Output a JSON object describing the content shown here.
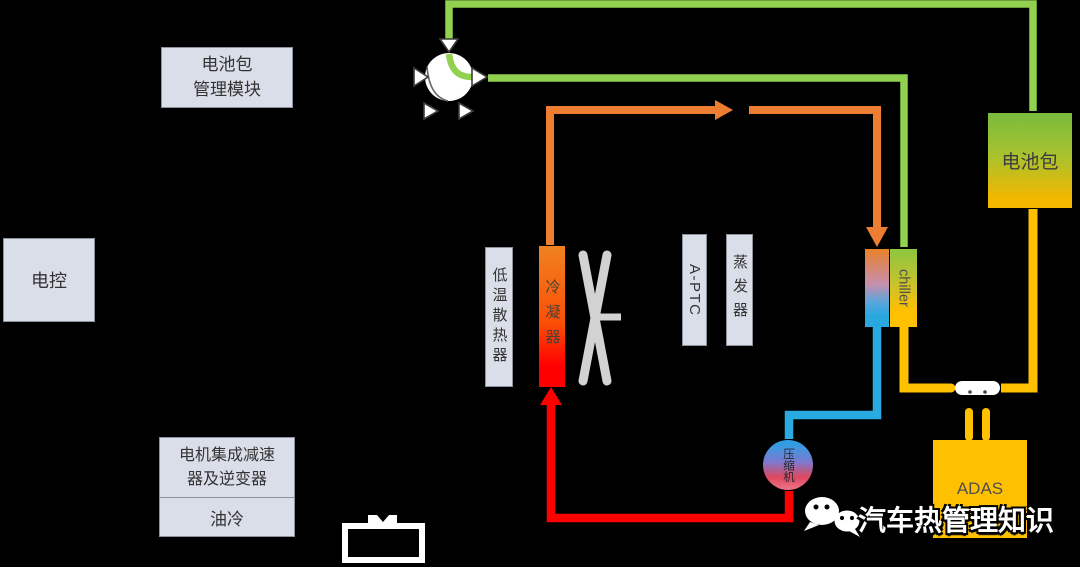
{
  "diagram_title": "EV thermal management schematic",
  "watermark": {
    "text": "汽车热管理知识",
    "icon": "wechat-logo-icon"
  },
  "components": {
    "battery_mgmt_module": {
      "line1": "电池包",
      "line2": "管理模块"
    },
    "motor_controller": {
      "label": "电控"
    },
    "motor_reducer_inverter": {
      "line1": "电机集成减速",
      "line2": "器及逆变器"
    },
    "oil_cooling": {
      "label": "油冷"
    },
    "lt_radiator": {
      "label": "低温散热器"
    },
    "condenser": {
      "label": "冷凝器"
    },
    "a_ptc": {
      "label": "A-PTC"
    },
    "evaporator": {
      "label": "蒸发器"
    },
    "chiller": {
      "label": "chiller"
    },
    "battery_pack": {
      "label": "电池包"
    },
    "adas": {
      "label": "ADAS"
    },
    "compressor": {
      "label": "压缩机"
    }
  },
  "icons": {
    "valve": "five-way-coolant-valve",
    "fan": "radiator-fan",
    "pump": "coolant-pump",
    "watermark": "wechat-logo"
  },
  "colors": {
    "background": "#000000",
    "coolant_green": "#92D050",
    "refrigerant_orange": "#ED7D31",
    "refrigerant_red": "#FF0000",
    "refrigerant_blue": "#29ABE2",
    "coolant_yellow": "#FFC000",
    "component_gray": "#D9DEE9",
    "adas_yellow": "#FFC000"
  }
}
